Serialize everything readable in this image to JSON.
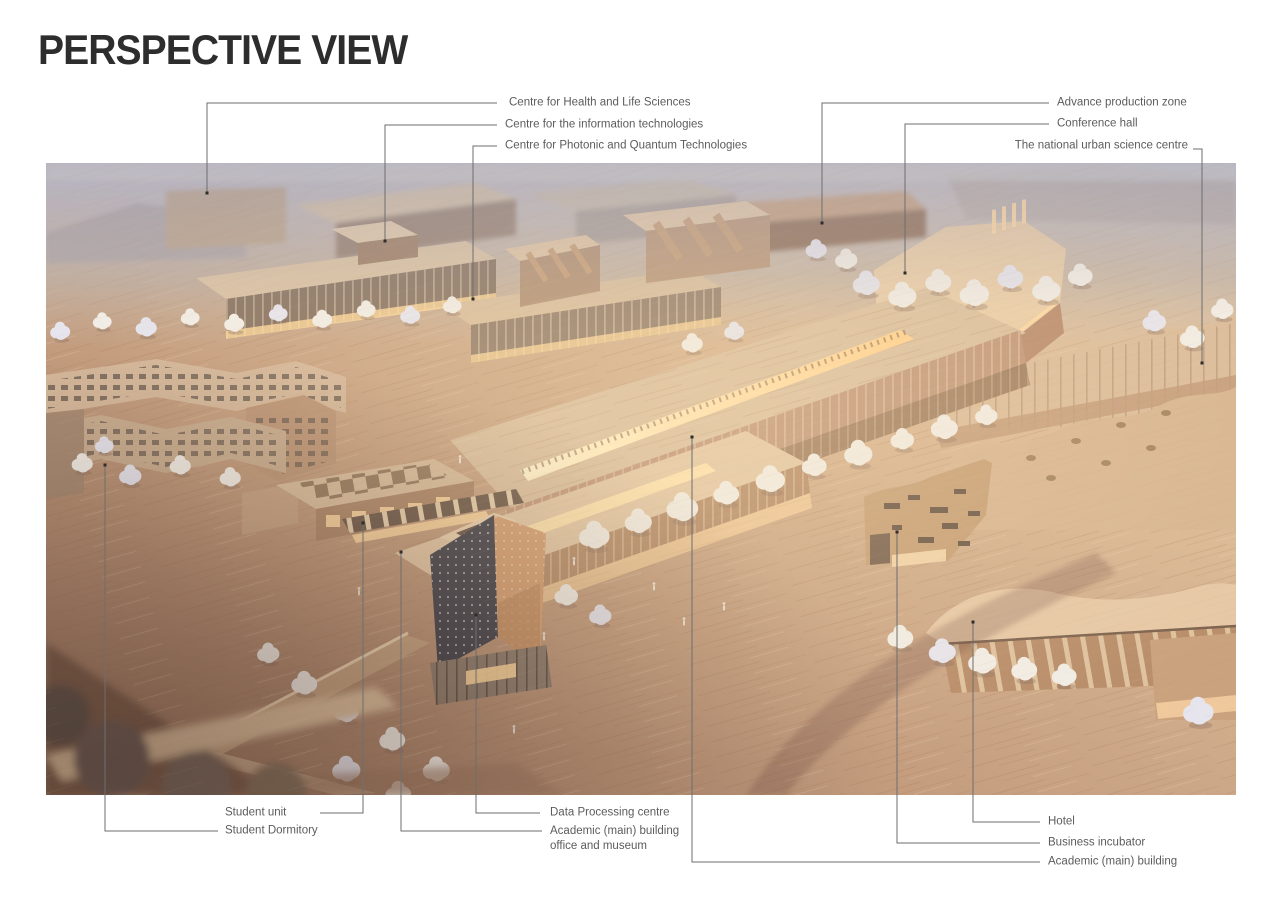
{
  "page": {
    "title": "PERSPECTIVE VIEW"
  },
  "photo": {
    "description": "Aerial photograph of a wooden architectural scale model of a campus masterplan in warm evening light",
    "palette": {
      "wood_light": "#e3c7a7",
      "wood_mid": "#c29b7d",
      "wood_shadow": "#8d6a57",
      "window_glow": "#ffd89a",
      "model_trees": "#f1ece5",
      "background_haze": "#c7c3cb"
    }
  },
  "callouts": {
    "top_left": [
      {
        "label": "Centre for Health and Life Sciences"
      },
      {
        "label": "Centre for the information technologies"
      },
      {
        "label": "Centre for Photonic and Quantum Technologies"
      }
    ],
    "top_right": [
      {
        "label": "Advance production zone"
      },
      {
        "label": "Conference hall"
      },
      {
        "label": "The national urban science centre"
      }
    ],
    "bottom_left": [
      {
        "label": "Student unit"
      },
      {
        "label": "Student Dormitory"
      }
    ],
    "bottom_center": [
      {
        "label": "Data Processing centre"
      },
      {
        "label": "Academic (main) building",
        "label_line2": "office and museum"
      }
    ],
    "bottom_right": [
      {
        "label": "Hotel"
      },
      {
        "label": "Business incubator"
      },
      {
        "label": "Academic (main) building"
      }
    ]
  }
}
